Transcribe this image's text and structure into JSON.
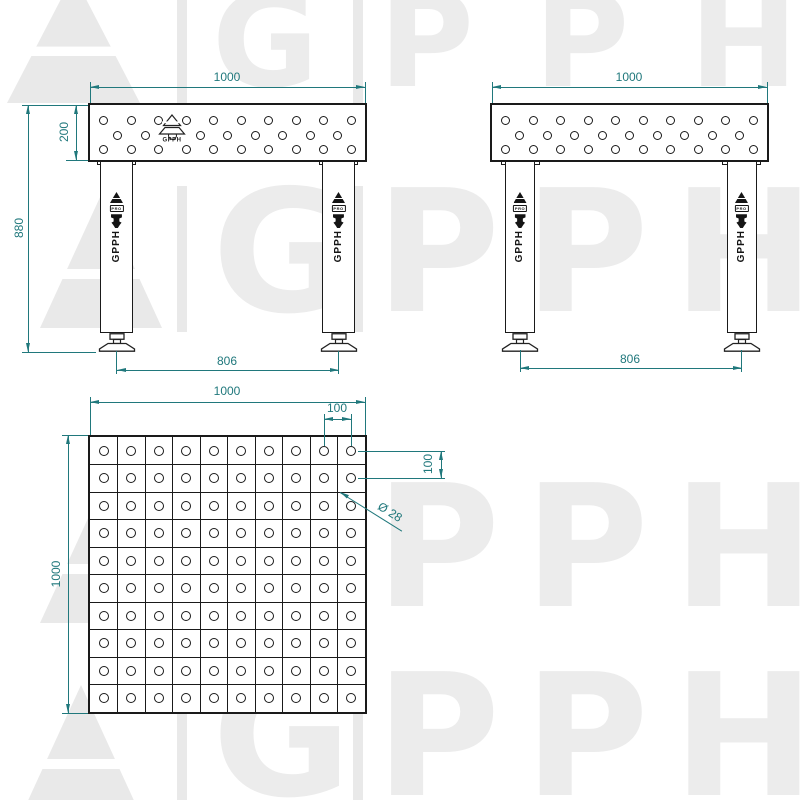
{
  "watermark": {
    "text": "GPPH",
    "letter_color": "#ececec",
    "shape_color": "#e9e9e9"
  },
  "colors": {
    "dimension": "#20787c",
    "line": "#1a1a1a"
  },
  "branding": {
    "pro_label": "PRO",
    "brand_name": "GPPH"
  },
  "views": {
    "front": {
      "dim_width": "1000",
      "dim_top_height": "200",
      "dim_total_height": "880",
      "dim_feet_span": "806",
      "hole_rows": [
        10,
        9,
        10
      ]
    },
    "side": {
      "dim_width": "1000",
      "dim_feet_span": "806",
      "hole_rows": [
        10,
        9,
        10
      ]
    },
    "top": {
      "dim_width": "1000",
      "dim_height": "1000",
      "dim_hole_spacing_x": "100",
      "dim_hole_spacing_y": "100",
      "dim_hole_diameter": "Ø 28",
      "grid_cols": 10,
      "grid_rows": 10
    }
  }
}
